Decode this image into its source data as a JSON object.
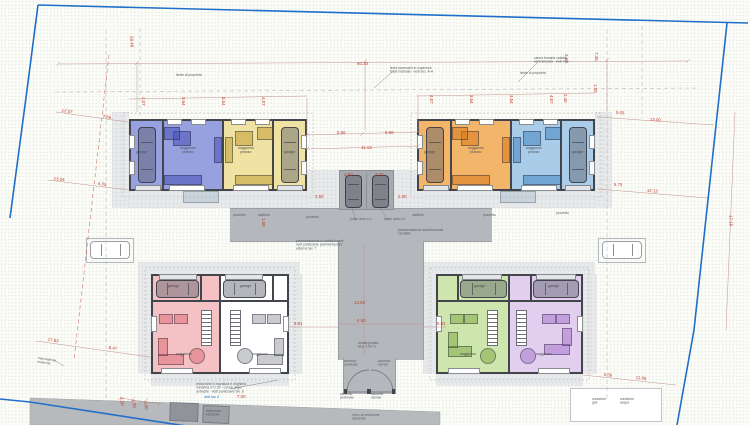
{
  "colors": {
    "boundary": "#1f6fc9",
    "road": "#b4b7bb",
    "pad": "#a6aaaf",
    "wall": "#43454c",
    "dim": "#c0392b",
    "ann": "#5c6064",
    "terrace": "#c9d3dc"
  },
  "units": [
    {
      "id": "blue",
      "fill": "#98a1e0",
      "furn": "rgba(70,80,180,0.55)"
    },
    {
      "id": "yellow",
      "fill": "#efe2a2",
      "furn": "rgba(190,150,40,0.5)"
    },
    {
      "id": "orange",
      "fill": "#f3b56a",
      "furn": "rgba(215,120,25,0.55)"
    },
    {
      "id": "lightblue",
      "fill": "#a9cde9",
      "furn": "rgba(60,125,185,0.5)"
    },
    {
      "id": "pink",
      "fill": "#f4c2c5",
      "furn": "rgba(215,95,105,0.45)"
    },
    {
      "id": "white",
      "fill": "#ffffff",
      "furn": "rgba(120,125,135,0.4)"
    },
    {
      "id": "green",
      "fill": "#cfe5ae",
      "furn": "rgba(120,165,60,0.5)"
    },
    {
      "id": "purple",
      "fill": "#e2cff0",
      "furn": "rgba(160,100,200,0.45)"
    }
  ],
  "dimensions": [
    {
      "t": "60.30",
      "x": 357,
      "y": 61,
      "r": 0
    },
    {
      "t": "29.48",
      "x": 134,
      "y": 36,
      "r": 88
    },
    {
      "t": "12.07",
      "x": 62,
      "y": 108,
      "r": 7
    },
    {
      "t": "7.66",
      "x": 103,
      "y": 114,
      "r": 7
    },
    {
      "t": "13.04",
      "x": 54,
      "y": 176,
      "r": 7
    },
    {
      "t": "4.33",
      "x": 98,
      "y": 181,
      "r": 7
    },
    {
      "t": "5.65",
      "x": 616,
      "y": 110,
      "r": 4
    },
    {
      "t": "13.00",
      "x": 650,
      "y": 117,
      "r": 4
    },
    {
      "t": "5.75",
      "x": 614,
      "y": 182,
      "r": 4
    },
    {
      "t": "12.12",
      "x": 647,
      "y": 188,
      "r": 4
    },
    {
      "t": "17.16",
      "x": 733,
      "y": 215,
      "r": 88
    },
    {
      "t": "5.56",
      "x": 337,
      "y": 130,
      "r": 0
    },
    {
      "t": "5.56",
      "x": 385,
      "y": 130,
      "r": 0
    },
    {
      "t": "11.13",
      "x": 361,
      "y": 145,
      "r": 0
    },
    {
      "t": "2.50",
      "x": 344,
      "y": 172,
      "r": 0
    },
    {
      "t": "2.50",
      "x": 375,
      "y": 172,
      "r": 0
    },
    {
      "t": "2.60",
      "x": 315,
      "y": 194,
      "r": 0
    },
    {
      "t": "2.60",
      "x": 398,
      "y": 194,
      "r": 0
    },
    {
      "t": "1.50",
      "x": 266,
      "y": 218,
      "r": 90
    },
    {
      "t": "13.92",
      "x": 354,
      "y": 300,
      "r": 0
    },
    {
      "t": "4.50",
      "x": 357,
      "y": 318,
      "r": 0
    },
    {
      "t": "5.91",
      "x": 294,
      "y": 321,
      "r": 0
    },
    {
      "t": "5.91",
      "x": 437,
      "y": 321,
      "r": 0
    },
    {
      "t": "17.83",
      "x": 48,
      "y": 337,
      "r": 8
    },
    {
      "t": "8.47",
      "x": 109,
      "y": 345,
      "r": 8
    },
    {
      "t": "5.56",
      "x": 604,
      "y": 372,
      "r": 6
    },
    {
      "t": "11.66",
      "x": 636,
      "y": 375,
      "r": 6
    },
    {
      "t": "7.00",
      "x": 237,
      "y": 394,
      "r": 0
    },
    {
      "t": "2.50",
      "x": 124,
      "y": 397,
      "r": 85
    },
    {
      "t": "1.50",
      "x": 136,
      "y": 399,
      "r": 85
    },
    {
      "t": "5.00",
      "x": 148,
      "y": 401,
      "r": 85
    },
    {
      "t": "3.65",
      "x": 569,
      "y": 54,
      "r": 90
    },
    {
      "t": "7.45",
      "x": 599,
      "y": 52,
      "r": 90
    },
    {
      "t": "2.40",
      "x": 568,
      "y": 94,
      "r": 90
    },
    {
      "t": "1.20",
      "x": 598,
      "y": 84,
      "r": 90
    },
    {
      "t": "4.07",
      "x": 146,
      "y": 97,
      "r": 90
    },
    {
      "t": "3.54",
      "x": 186,
      "y": 97,
      "r": 90
    },
    {
      "t": "3.54",
      "x": 226,
      "y": 97,
      "r": 90
    },
    {
      "t": "4.07",
      "x": 266,
      "y": 97,
      "r": 90
    },
    {
      "t": "4.07",
      "x": 434,
      "y": 95,
      "r": 90
    },
    {
      "t": "3.54",
      "x": 474,
      "y": 95,
      "r": 90
    },
    {
      "t": "3.54",
      "x": 514,
      "y": 95,
      "r": 90
    },
    {
      "t": "4.07",
      "x": 554,
      "y": 95,
      "r": 90
    }
  ],
  "annotations": [
    {
      "t": "limite di proprieta'",
      "x": 176,
      "y": 73
    },
    {
      "t": "limite di proprieta'",
      "x": 520,
      "y": 71
    },
    {
      "t": "linea lucernario in copertura\nfalda inclinata - vedi sez. A-A",
      "x": 390,
      "y": 66
    },
    {
      "t": "canna fumaria caldaia\ncentralizzata - vedi imp.",
      "x": 534,
      "y": 56
    },
    {
      "t": "pozzetto",
      "x": 233,
      "y": 213
    },
    {
      "t": "caditoia",
      "x": 258,
      "y": 213
    },
    {
      "t": "pozzetto",
      "x": 306,
      "y": 215
    },
    {
      "t": "caditoia",
      "x": 412,
      "y": 213
    },
    {
      "t": "pozzetto",
      "x": 483,
      "y": 213
    },
    {
      "t": "pozzetto",
      "x": 556,
      "y": 211
    },
    {
      "t": "posto auto n.1",
      "x": 350,
      "y": 217
    },
    {
      "t": "posto auto n.2",
      "x": 384,
      "y": 217
    },
    {
      "t": "pavimentazione autobloccante\ncarrabile",
      "x": 398,
      "y": 228
    },
    {
      "t": "pavimentazione in autobloccanti -\nvedi particolare pavimentazioni\nesterne tav. 7",
      "x": 296,
      "y": 239
    },
    {
      "t": "strada privata\nlarg. 4.50 m",
      "x": 358,
      "y": 341
    },
    {
      "t": "accesso\npedonale",
      "x": 344,
      "y": 359
    },
    {
      "t": "accesso\ncarraio",
      "x": 378,
      "y": 359
    },
    {
      "t": "cancello\npedonale",
      "x": 340,
      "y": 392
    },
    {
      "t": "cancello\ncarraio",
      "x": 371,
      "y": 392
    },
    {
      "t": "recinzione in muratura e ringhiera\nmetallica h=1.50 - colore grigio\nantracite - vedi particolare tav. 8",
      "x": 196,
      "y": 382
    },
    {
      "t": "vedi tav. 8",
      "x": 204,
      "y": 395,
      "c": "#1f6fc9"
    },
    {
      "t": "marciapiede\nesistente",
      "x": 38,
      "y": 356,
      "r": 8
    },
    {
      "t": "fabbricato\nesistente",
      "x": 206,
      "y": 409
    },
    {
      "t": "muro di recinzione\nesistente",
      "x": 352,
      "y": 413
    },
    {
      "t": "contatore\ngas",
      "x": 592,
      "y": 397
    },
    {
      "t": "contatore\nacqua",
      "x": 620,
      "y": 397
    }
  ],
  "room_labels": [
    {
      "t": "garage",
      "x": 136,
      "y": 150
    },
    {
      "t": "soggiorno\npranzo",
      "x": 180,
      "y": 146
    },
    {
      "t": "soggiorno\npranzo",
      "x": 238,
      "y": 146
    },
    {
      "t": "garage",
      "x": 284,
      "y": 150
    },
    {
      "t": "garage",
      "x": 424,
      "y": 150
    },
    {
      "t": "soggiorno\npranzo",
      "x": 468,
      "y": 146
    },
    {
      "t": "soggiorno\npranzo",
      "x": 526,
      "y": 146
    },
    {
      "t": "garage",
      "x": 572,
      "y": 150
    },
    {
      "t": "garage",
      "x": 168,
      "y": 284
    },
    {
      "t": "soggiorno",
      "x": 176,
      "y": 352
    },
    {
      "t": "garage",
      "x": 240,
      "y": 284
    },
    {
      "t": "soggiorno",
      "x": 252,
      "y": 352
    },
    {
      "t": "garage",
      "x": 474,
      "y": 284
    },
    {
      "t": "soggiorno",
      "x": 460,
      "y": 352
    },
    {
      "t": "garage",
      "x": 548,
      "y": 284
    },
    {
      "t": "soggiorno",
      "x": 536,
      "y": 352
    }
  ]
}
